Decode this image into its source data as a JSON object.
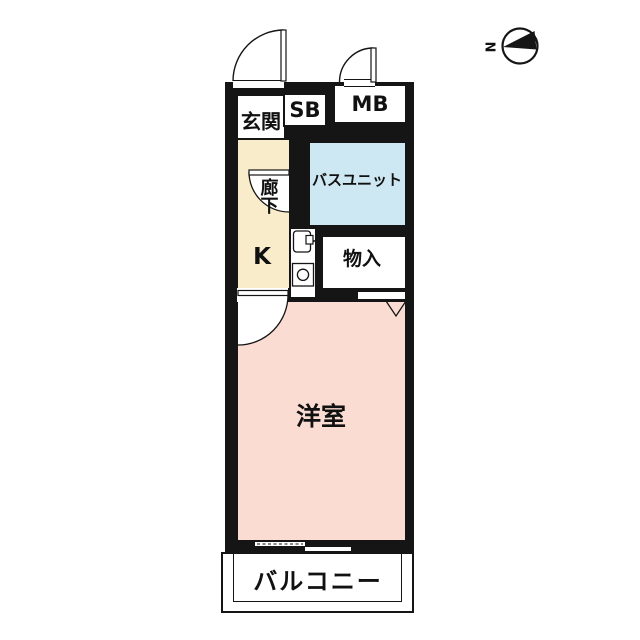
{
  "compass": {
    "north_label": "N"
  },
  "labels": {
    "genkan": "玄関",
    "shoe_box": "SB",
    "meter_box": "MB",
    "bath_unit": "バスユニット",
    "corridor": "廊下",
    "kitchen": "K",
    "storage": "物入",
    "western_room": "洋室",
    "balcony": "バルコニー"
  },
  "colors": {
    "wall": "#151515",
    "corridor_kitchen": "#f9ecca",
    "bath": "#cde7f3",
    "western_room": "#fbdcd3"
  }
}
